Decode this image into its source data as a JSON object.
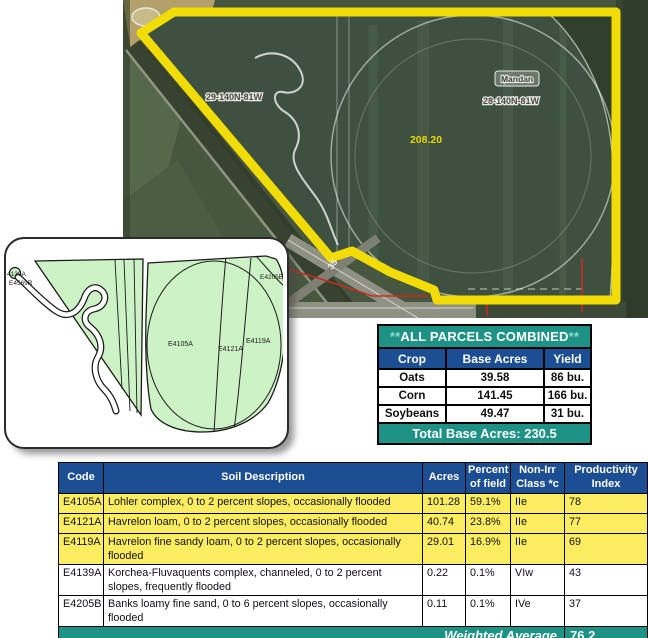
{
  "aerial": {
    "labels": {
      "section_left": "29-140N-81W",
      "city": "Mandan",
      "section_right": "28-140N-81W",
      "acres": "208.20",
      "road": "35"
    },
    "colors": {
      "boundary": "#F1DC05",
      "acres_text": "#E8DE00",
      "red_line": "#C92A1C"
    }
  },
  "soil_map": {
    "labels": {
      "tiny_top": "4139A",
      "tiny_bottom": "E4569R",
      "corner": "E4205B",
      "main": "E4105A",
      "mid": "E4121A",
      "right": "E4119A"
    },
    "fill_color": "#CDF2C5"
  },
  "crop_table": {
    "title_prefix": "**",
    "title": "ALL PARCELS COMBINED",
    "title_suffix": "**",
    "columns": [
      "Crop",
      "Base Acres",
      "Yield"
    ],
    "rows": [
      [
        "Oats",
        "39.58",
        "86 bu."
      ],
      [
        "Corn",
        "141.45",
        "166 bu."
      ],
      [
        "Soybeans",
        "49.47",
        "31 bu."
      ]
    ],
    "footer": "Total Base Acres:  230.5"
  },
  "soil_table": {
    "columns": [
      "Code",
      "Soil Description",
      "Acres",
      "Percent of field",
      "Non-Irr Class *c",
      "Productivity Index"
    ],
    "rows": [
      {
        "code": "E4105A",
        "desc": "Lohler complex, 0 to 2 percent slopes, occasionally flooded",
        "acres": "101.28",
        "pct": "59.1%",
        "cls": "IIe",
        "pi": "78",
        "hl": true,
        "lines": 1
      },
      {
        "code": "E4121A",
        "desc": "Havrelon loam, 0 to 2 percent slopes, occasionally flooded",
        "acres": "40.74",
        "pct": "23.8%",
        "cls": "IIe",
        "pi": "77",
        "hl": true,
        "lines": 1
      },
      {
        "code": "E4119A",
        "desc": "Havrelon fine sandy loam, 0 to 2 percent slopes, occasionally flooded",
        "acres": "29.01",
        "pct": "16.9%",
        "cls": "IIe",
        "pi": "69",
        "hl": true,
        "lines": 2
      },
      {
        "code": "E4139A",
        "desc": "Korchea-Fluvaquents complex, channeled, 0 to 2 percent slopes, frequently flooded",
        "acres": "0.22",
        "pct": "0.1%",
        "cls": "VIw",
        "pi": "43",
        "hl": false,
        "lines": 2
      },
      {
        "code": "E4205B",
        "desc": "Banks loamy fine sand, 0 to 6 percent slopes, occasionally flooded",
        "acres": "0.11",
        "pct": "0.1%",
        "cls": "IVe",
        "pi": "37",
        "hl": false,
        "lines": 2
      }
    ],
    "footer_label": "Weighted Average",
    "footer_value": "76.2"
  },
  "colors": {
    "teal": "#1F9286",
    "blue": "#1C4E94",
    "row_yellow": "#FCEC60"
  }
}
